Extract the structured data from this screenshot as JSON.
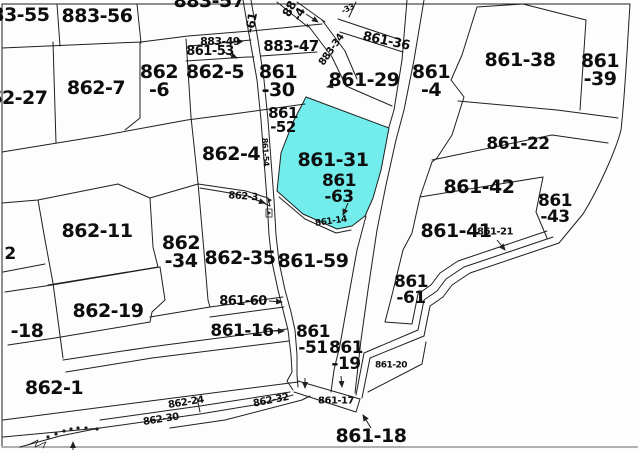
{
  "map": {
    "type": "cadastral-parcel-map",
    "highlighted_parcel": "861-31",
    "colors": {
      "background": "#fdfdfd",
      "line": "#1f1f1f",
      "highlight_fill": "#73EDEC",
      "frame_bottom": "#b0b0b0"
    },
    "labels": [
      {
        "t": "883-55",
        "x": 14,
        "y": 15,
        "s": 19
      },
      {
        "t": "883-56",
        "x": 97,
        "y": 16,
        "s": 19
      },
      {
        "t": "883-57",
        "x": 209,
        "y": 1,
        "s": 19
      },
      {
        "t": "-61",
        "x": 252,
        "y": 23,
        "s": 12,
        "r": -80
      },
      {
        "t": "88\n-4",
        "x": 295,
        "y": 12,
        "s": 12,
        "r": -62
      },
      {
        "t": "-33",
        "x": 348,
        "y": 9,
        "s": 8,
        "r": -25
      },
      {
        "t": "883-49",
        "x": 220,
        "y": 42,
        "s": 11
      },
      {
        "t": "861-53",
        "x": 210,
        "y": 52,
        "s": 13
      },
      {
        "t": "883-47",
        "x": 291,
        "y": 46,
        "s": 15
      },
      {
        "t": "883-34",
        "x": 332,
        "y": 50,
        "s": 10,
        "r": -55
      },
      {
        "t": "861-36",
        "x": 386,
        "y": 42,
        "s": 13,
        "r": 12
      },
      {
        "t": "861-29",
        "x": 364,
        "y": 80,
        "s": 19
      },
      {
        "t": "861\n-4",
        "x": 431,
        "y": 81,
        "s": 19
      },
      {
        "t": "861-38",
        "x": 520,
        "y": 60,
        "s": 19
      },
      {
        "t": "861\n-39",
        "x": 600,
        "y": 70,
        "s": 19
      },
      {
        "t": "862-27",
        "x": 12,
        "y": 98,
        "s": 19
      },
      {
        "t": "862-7",
        "x": 96,
        "y": 88,
        "s": 19
      },
      {
        "t": "862\n-6",
        "x": 159,
        "y": 81,
        "s": 19
      },
      {
        "t": "862-5",
        "x": 215,
        "y": 72,
        "s": 19
      },
      {
        "t": "861\n-30",
        "x": 278,
        "y": 81,
        "s": 19
      },
      {
        "t": "861\n-52",
        "x": 283,
        "y": 120,
        "s": 15
      },
      {
        "t": "862-4",
        "x": 231,
        "y": 154,
        "s": 19
      },
      {
        "t": "861-54",
        "x": 265,
        "y": 152,
        "s": 8,
        "r": 86
      },
      {
        "t": "861-31",
        "x": 333,
        "y": 160,
        "s": 19
      },
      {
        "t": "861\n-63",
        "x": 339,
        "y": 189,
        "s": 17
      },
      {
        "t": "862-3",
        "x": 243,
        "y": 197,
        "s": 10,
        "r": 4
      },
      {
        "t": "861-14",
        "x": 331,
        "y": 222,
        "s": 9,
        "r": -8
      },
      {
        "t": "861-22",
        "x": 518,
        "y": 144,
        "s": 17
      },
      {
        "t": "861-42",
        "x": 479,
        "y": 187,
        "s": 19
      },
      {
        "t": "861\n-43",
        "x": 555,
        "y": 209,
        "s": 17
      },
      {
        "t": "861-41",
        "x": 456,
        "y": 231,
        "s": 19
      },
      {
        "t": "861-21",
        "x": 495,
        "y": 232,
        "s": 10
      },
      {
        "t": "862-11",
        "x": 97,
        "y": 231,
        "s": 19
      },
      {
        "t": "862\n-34",
        "x": 181,
        "y": 252,
        "s": 19
      },
      {
        "t": "862-35",
        "x": 240,
        "y": 258,
        "s": 19
      },
      {
        "t": "861-59",
        "x": 313,
        "y": 261,
        "s": 19
      },
      {
        "t": "861\n-61",
        "x": 411,
        "y": 290,
        "s": 17
      },
      {
        "t": "861-60",
        "x": 243,
        "y": 302,
        "s": 13
      },
      {
        "t": "861-16",
        "x": 242,
        "y": 331,
        "s": 17
      },
      {
        "t": "861\n-51",
        "x": 313,
        "y": 340,
        "s": 17
      },
      {
        "t": "861\n-19",
        "x": 346,
        "y": 356,
        "s": 17
      },
      {
        "t": "861-20",
        "x": 391,
        "y": 366,
        "s": 9
      },
      {
        "t": "862-19",
        "x": 108,
        "y": 311,
        "s": 19
      },
      {
        "t": "-18",
        "x": 27,
        "y": 331,
        "s": 19
      },
      {
        "t": "2",
        "x": 10,
        "y": 254,
        "s": 17
      },
      {
        "t": "862-1",
        "x": 54,
        "y": 388,
        "s": 19
      },
      {
        "t": "862-24",
        "x": 186,
        "y": 403,
        "s": 10,
        "r": -9
      },
      {
        "t": "862-30",
        "x": 161,
        "y": 420,
        "s": 10,
        "r": -9
      },
      {
        "t": "862-32",
        "x": 271,
        "y": 401,
        "s": 10,
        "r": -11
      },
      {
        "t": "861-17",
        "x": 336,
        "y": 401,
        "s": 10
      },
      {
        "t": "861-18",
        "x": 371,
        "y": 436,
        "s": 19
      }
    ]
  }
}
